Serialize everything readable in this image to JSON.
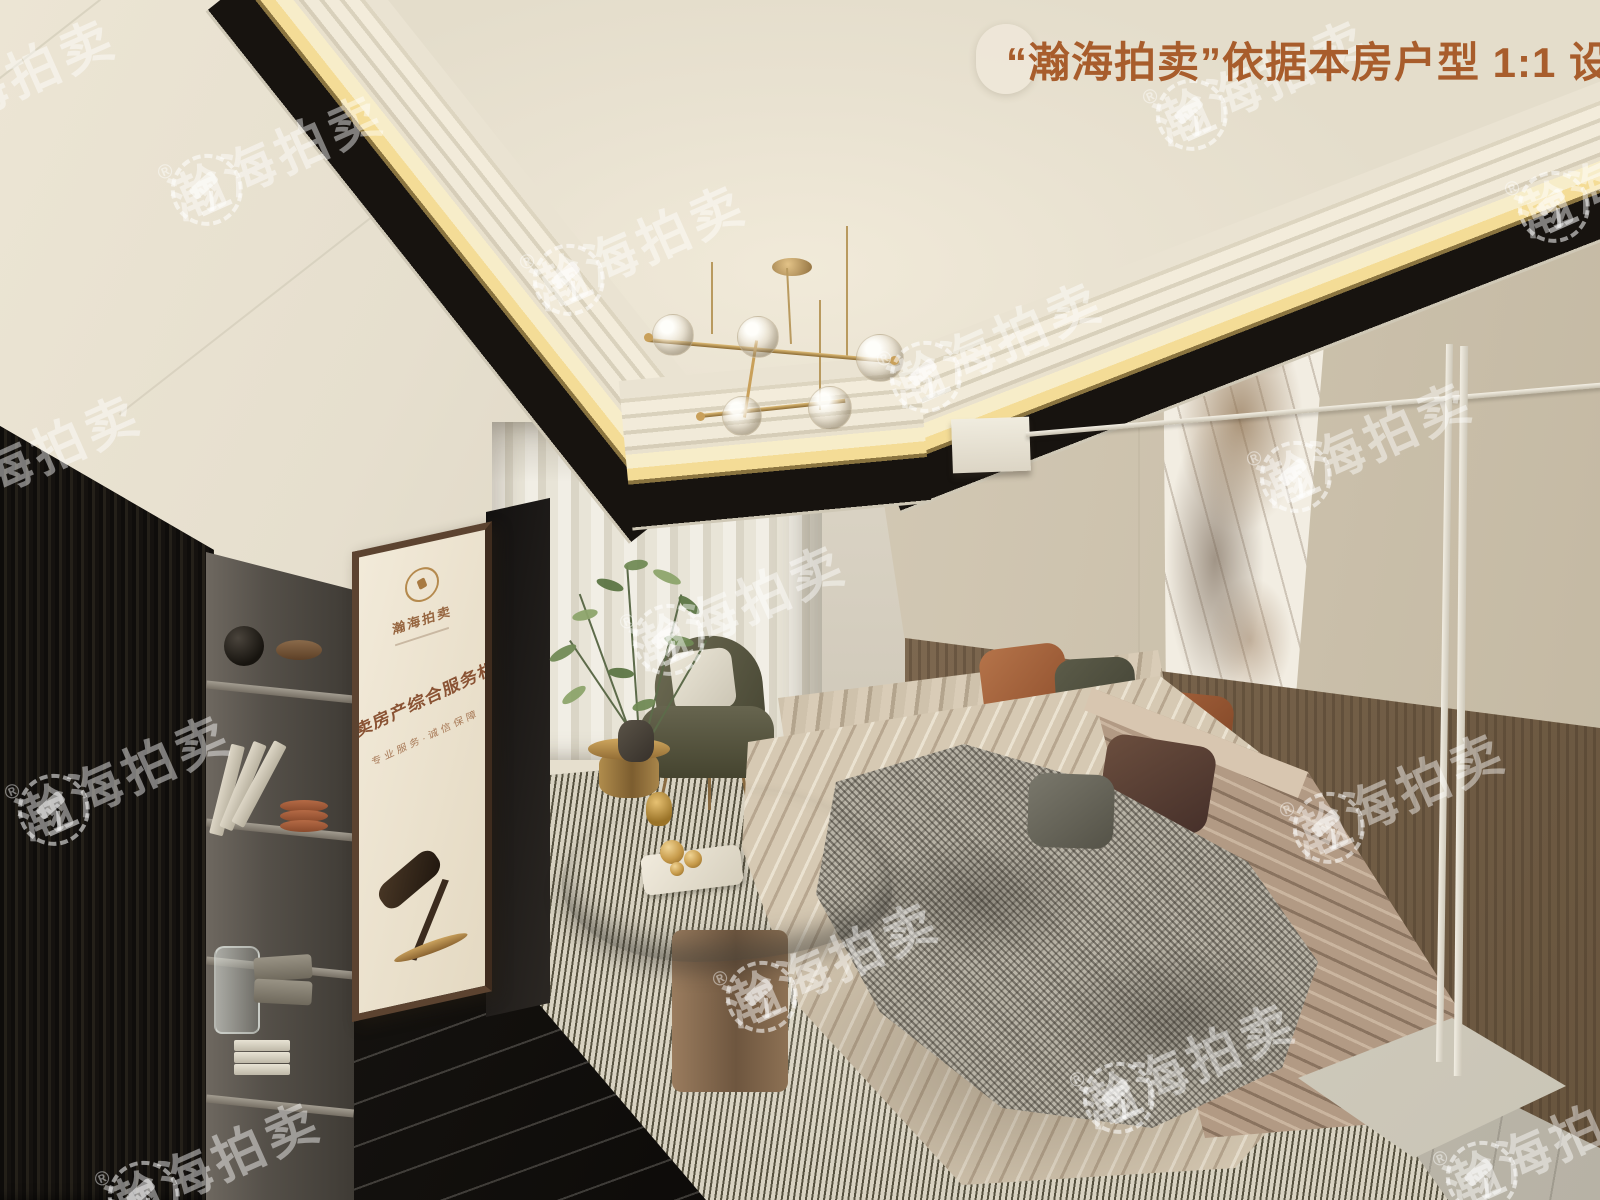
{
  "overlay": {
    "badge": {
      "text": "“瀚海拍卖”依据本房户型 1:1 设计",
      "text_color": "#a85d2c",
      "bg_color": "#eee7d9"
    },
    "watermark": {
      "text": "瀚海拍卖",
      "registered_mark": "®",
      "logo": "laurel-wreath-gavel-emblem",
      "color": "#ffffff",
      "opacity": 0.45,
      "count": 15
    }
  },
  "poster": {
    "logo_text": "瀚海拍卖",
    "headline": "拍卖房产综合服务机构",
    "tagline": "专业服务·诚信保障",
    "artwork": "auction-gavel"
  },
  "scene": {
    "room": "living-room-interior-render",
    "elements": [
      "tray-ceiling-with-cove-lighting",
      "gold-glass-globe-chandelier",
      "black-slatted-wardrobe",
      "gray-open-shelving",
      "framed-auction-poster",
      "black-tv-screen",
      "black-marble-media-console-with-fireplace",
      "sheer-curtains",
      "olive-accent-chair",
      "indoor-plant",
      "gold-side-table",
      "sculptural-chrome-coffee-table",
      "beige-channel-tufted-sofa",
      "throw-pillows",
      "houndstooth-throw-blanket",
      "striped-area-rug",
      "wood-panel-wainscot",
      "marble-art-panel",
      "white-floor-lamp",
      "wall-mounted-box"
    ],
    "palette": {
      "ceiling": "#ebe4d3",
      "cove_glow": "#f4dc96",
      "ceiling_recess": "#17130f",
      "wall": "#e3dbc9",
      "wood_wainscot": "#8a7260",
      "sofa": "#d2c4ae",
      "sofa_arm": "#b29a84",
      "rug": "#b5afa2",
      "pillow_rust": "#a15a35",
      "pillow_olive": "#4f4f41",
      "pillow_brown": "#5c4537",
      "chair_olive": "#5e5c47",
      "gold": "#c8a260",
      "black": "#16120e"
    }
  }
}
